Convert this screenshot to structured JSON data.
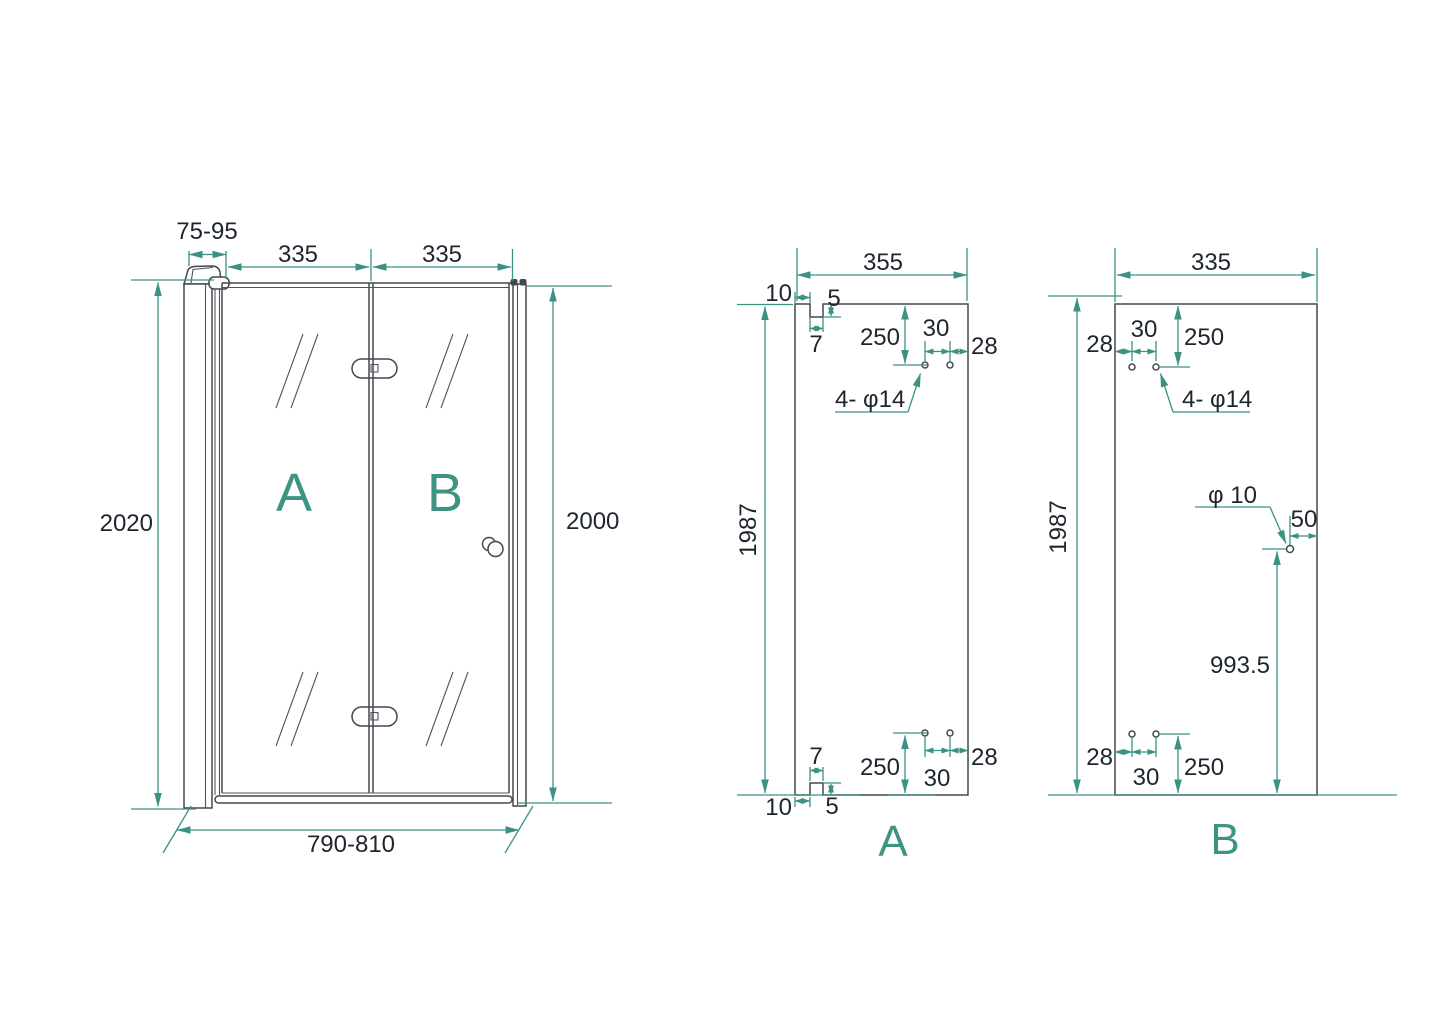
{
  "diagram": {
    "title": "folding shower door dimension drawing",
    "accent_color": "#3B9183",
    "geometry_color": "#43484F",
    "text_color": "#1F252E",
    "front_view": {
      "wall_clearance": "75-95",
      "panel_a_width": "335",
      "panel_b_width": "335",
      "total_height": "2020",
      "door_height": "2000",
      "total_width": "790-810",
      "panel_a_letter": "A",
      "panel_b_letter": "B"
    },
    "panel_a": {
      "width": "355",
      "height": "1987",
      "label": "A",
      "top": {
        "inset": "10",
        "depth": "5",
        "notch": "7",
        "hole_v": "250",
        "hole_gap": "30",
        "hole_edge": "28",
        "note": "4- φ14"
      },
      "bottom": {
        "inset": "10",
        "depth": "5",
        "notch": "7",
        "hole_v": "250",
        "hole_gap": "30",
        "hole_edge": "28"
      }
    },
    "panel_b": {
      "width": "335",
      "height": "1987",
      "label": "B",
      "top": {
        "hole_edge": "28",
        "hole_gap": "30",
        "hole_v": "250",
        "note": "4- φ14"
      },
      "middle": {
        "hole_dia": "φ 10",
        "edge_offset": "50",
        "height_offset": "993.5"
      },
      "bottom": {
        "hole_edge": "28",
        "hole_gap": "30",
        "hole_v": "250"
      }
    }
  }
}
